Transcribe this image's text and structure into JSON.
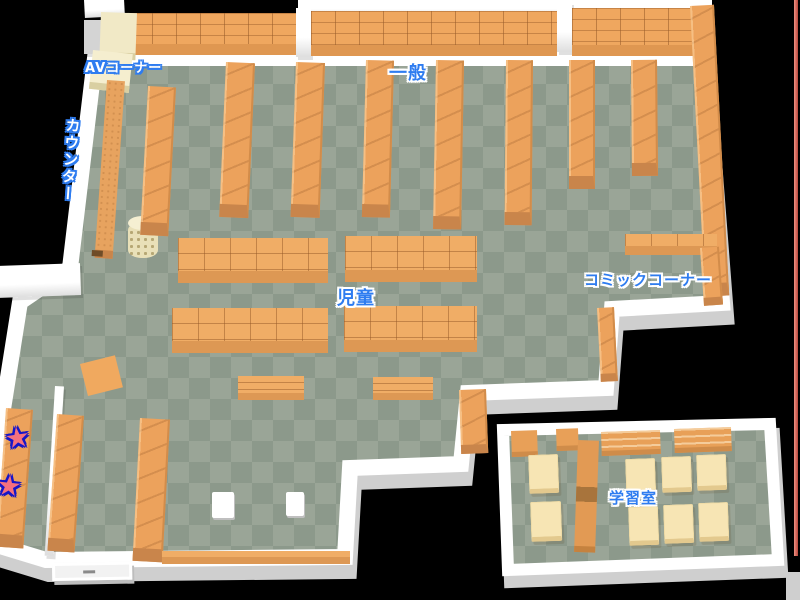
{
  "map": {
    "title": "library-floor-map",
    "regions": {
      "av_corner": {
        "label": "AVコーナー"
      },
      "counter": {
        "label": "カウンター"
      },
      "general": {
        "label": "一般"
      },
      "children": {
        "label": "児童"
      },
      "comic_corner": {
        "label": "コミックコーナー"
      },
      "study_room": {
        "label": "学習室"
      }
    },
    "markers": {
      "glyph": "★",
      "count": 2,
      "fill_color": "#f5707e",
      "outline_color": "#1616c8"
    },
    "palette": {
      "background": "#000000",
      "floor_light": "#9aa597",
      "floor_dark": "#8c998b",
      "wall": "#ffffff",
      "wall_shadow": "#cfcfcf",
      "shelf": "#eca25c",
      "shelf_front": "#c9854b",
      "cream_shelf": "#f1e9c6",
      "desk": "#f7e5b4",
      "label_blue": "#2e7cf0",
      "edge_line": "#d9655a"
    }
  }
}
